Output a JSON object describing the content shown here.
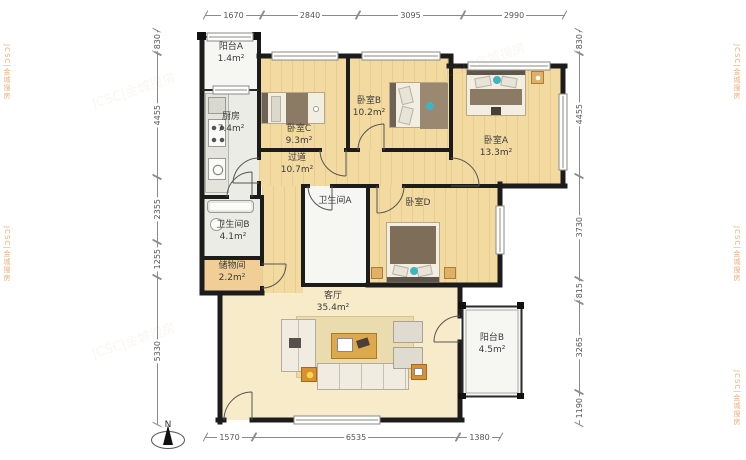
{
  "plan": {
    "type": "apartment-floor-plan",
    "north_label": "N",
    "watermark": {
      "text": "JCSC|金城搜房"
    },
    "rooms": {
      "balcony_a": {
        "name": "阳台A",
        "area": "1.4m²"
      },
      "kitchen": {
        "name": "厨房",
        "area": "7.4m²"
      },
      "bedroom_c": {
        "name": "卧室C",
        "area": "9.3m²"
      },
      "bedroom_b": {
        "name": "卧室B",
        "area": "10.2m²"
      },
      "bedroom_a": {
        "name": "卧室A",
        "area": "13.3m²"
      },
      "hallway": {
        "name": "过道",
        "area": "10.7m²"
      },
      "bathroom_a": {
        "name": "卫生间A",
        "area": ""
      },
      "bathroom_b": {
        "name": "卫生间B",
        "area": "4.1m²"
      },
      "storage": {
        "name": "储物间",
        "area": "2.2m²"
      },
      "bedroom_d": {
        "name": "卧室D",
        "area": ""
      },
      "living_room": {
        "name": "客厅",
        "area": "35.4m²"
      },
      "balcony_b": {
        "name": "阳台B",
        "area": "4.5m²"
      }
    },
    "dimensions": {
      "top": [
        "1670",
        "2840",
        "3095",
        "2990"
      ],
      "bottom": [
        "1570",
        "6535",
        "1380"
      ],
      "left": [
        "830",
        "4455",
        "2355",
        "1255",
        "5330"
      ],
      "right": [
        "830",
        "4455",
        "3730",
        "815",
        "3265",
        "1190"
      ]
    },
    "colors": {
      "wall": "#1C1C1C",
      "wood_floor": "#F2DAA1",
      "living_floor": "#F8EBC9",
      "storage_floor": "#F0CE96",
      "watermark_orange": "#E8A05F",
      "teal_accent": "#3FB4C4",
      "table_orange": "#D89030"
    }
  }
}
